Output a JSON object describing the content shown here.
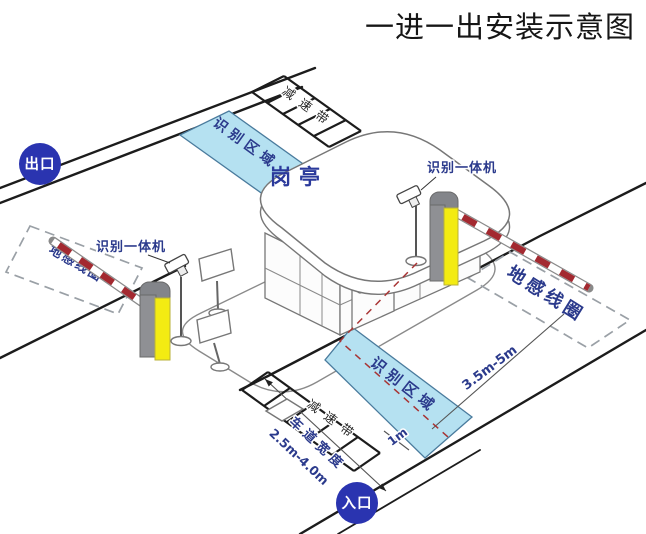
{
  "title": "一进一出安装示意图",
  "badges": {
    "exit": "出口",
    "entrance": "入口"
  },
  "booth": {
    "label": "岗亭"
  },
  "zones": {
    "recognition_top": "识别区域",
    "recognition_bottom": "识别区域",
    "loop_left": "地感线圈",
    "loop_right": "地感线圈"
  },
  "devices": {
    "camera_left": "识别一体机",
    "camera_right": "识别一体机"
  },
  "road": {
    "speed_bump_top": "减速带",
    "speed_bump_bottom": "减速带",
    "lane_width_label": "车道宽度",
    "lane_width_value": "2.5m-4.0m",
    "loop_distance": "3.5m-5m",
    "stop_distance": "1m"
  },
  "colors": {
    "zone_fill": "#b5e1f1",
    "zone_border": "#4a7b9d",
    "badge_blue": "#2a34b0",
    "machine_yellow": "#f3eb12",
    "machine_gray": "#8f9094",
    "arm_red": "#a32930",
    "label_navy": "#2b3a8c",
    "road_black": "#1c1c1c"
  }
}
